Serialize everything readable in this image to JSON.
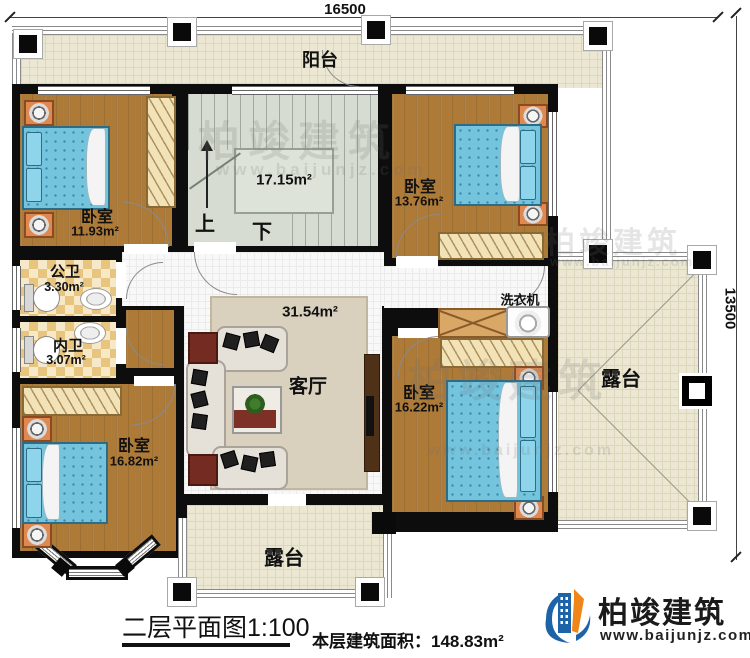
{
  "dimensions": {
    "width_label": "16500",
    "height_label": "13500"
  },
  "balcony": {
    "label": "阳台"
  },
  "stairwell": {
    "area": "17.15m²",
    "up": "上",
    "down": "下"
  },
  "bedroom_top_left": {
    "label": "卧室",
    "area": "11.93m²"
  },
  "bedroom_top_right": {
    "label": "卧室",
    "area": "13.76m²"
  },
  "public_bathroom": {
    "label": "公卫",
    "area": "3.30m²"
  },
  "private_bathroom": {
    "label": "内卫",
    "area": "3.07m²"
  },
  "living_room": {
    "label": "客厅",
    "area": "31.54m²"
  },
  "laundry": {
    "label": "洗衣机"
  },
  "bedroom_right": {
    "label": "卧室",
    "area": "16.22m²"
  },
  "bedroom_bottom_left": {
    "label": "卧室",
    "area": "16.82m²"
  },
  "terrace_right": {
    "label": "露台"
  },
  "terrace_bottom": {
    "label": "露台"
  },
  "title_block": {
    "plan_title": "二层平面图1:100",
    "floor_area": "本层建筑面积：148.83m²"
  },
  "brand": {
    "name": "柏竣建筑",
    "website": "www.baijunjz.com"
  },
  "watermark": {
    "name": "柏竣建筑",
    "website": "www.baijunjz.com"
  },
  "colors": {
    "wall": "#0d0d0d",
    "wood_floor": "#ad7a37",
    "terrace_floor": "#ebe7d3",
    "tile_floor": "#e8c57e",
    "bed": "#74c4de",
    "brand_blue": "#1c63a8",
    "brand_orange": "#f08519"
  }
}
